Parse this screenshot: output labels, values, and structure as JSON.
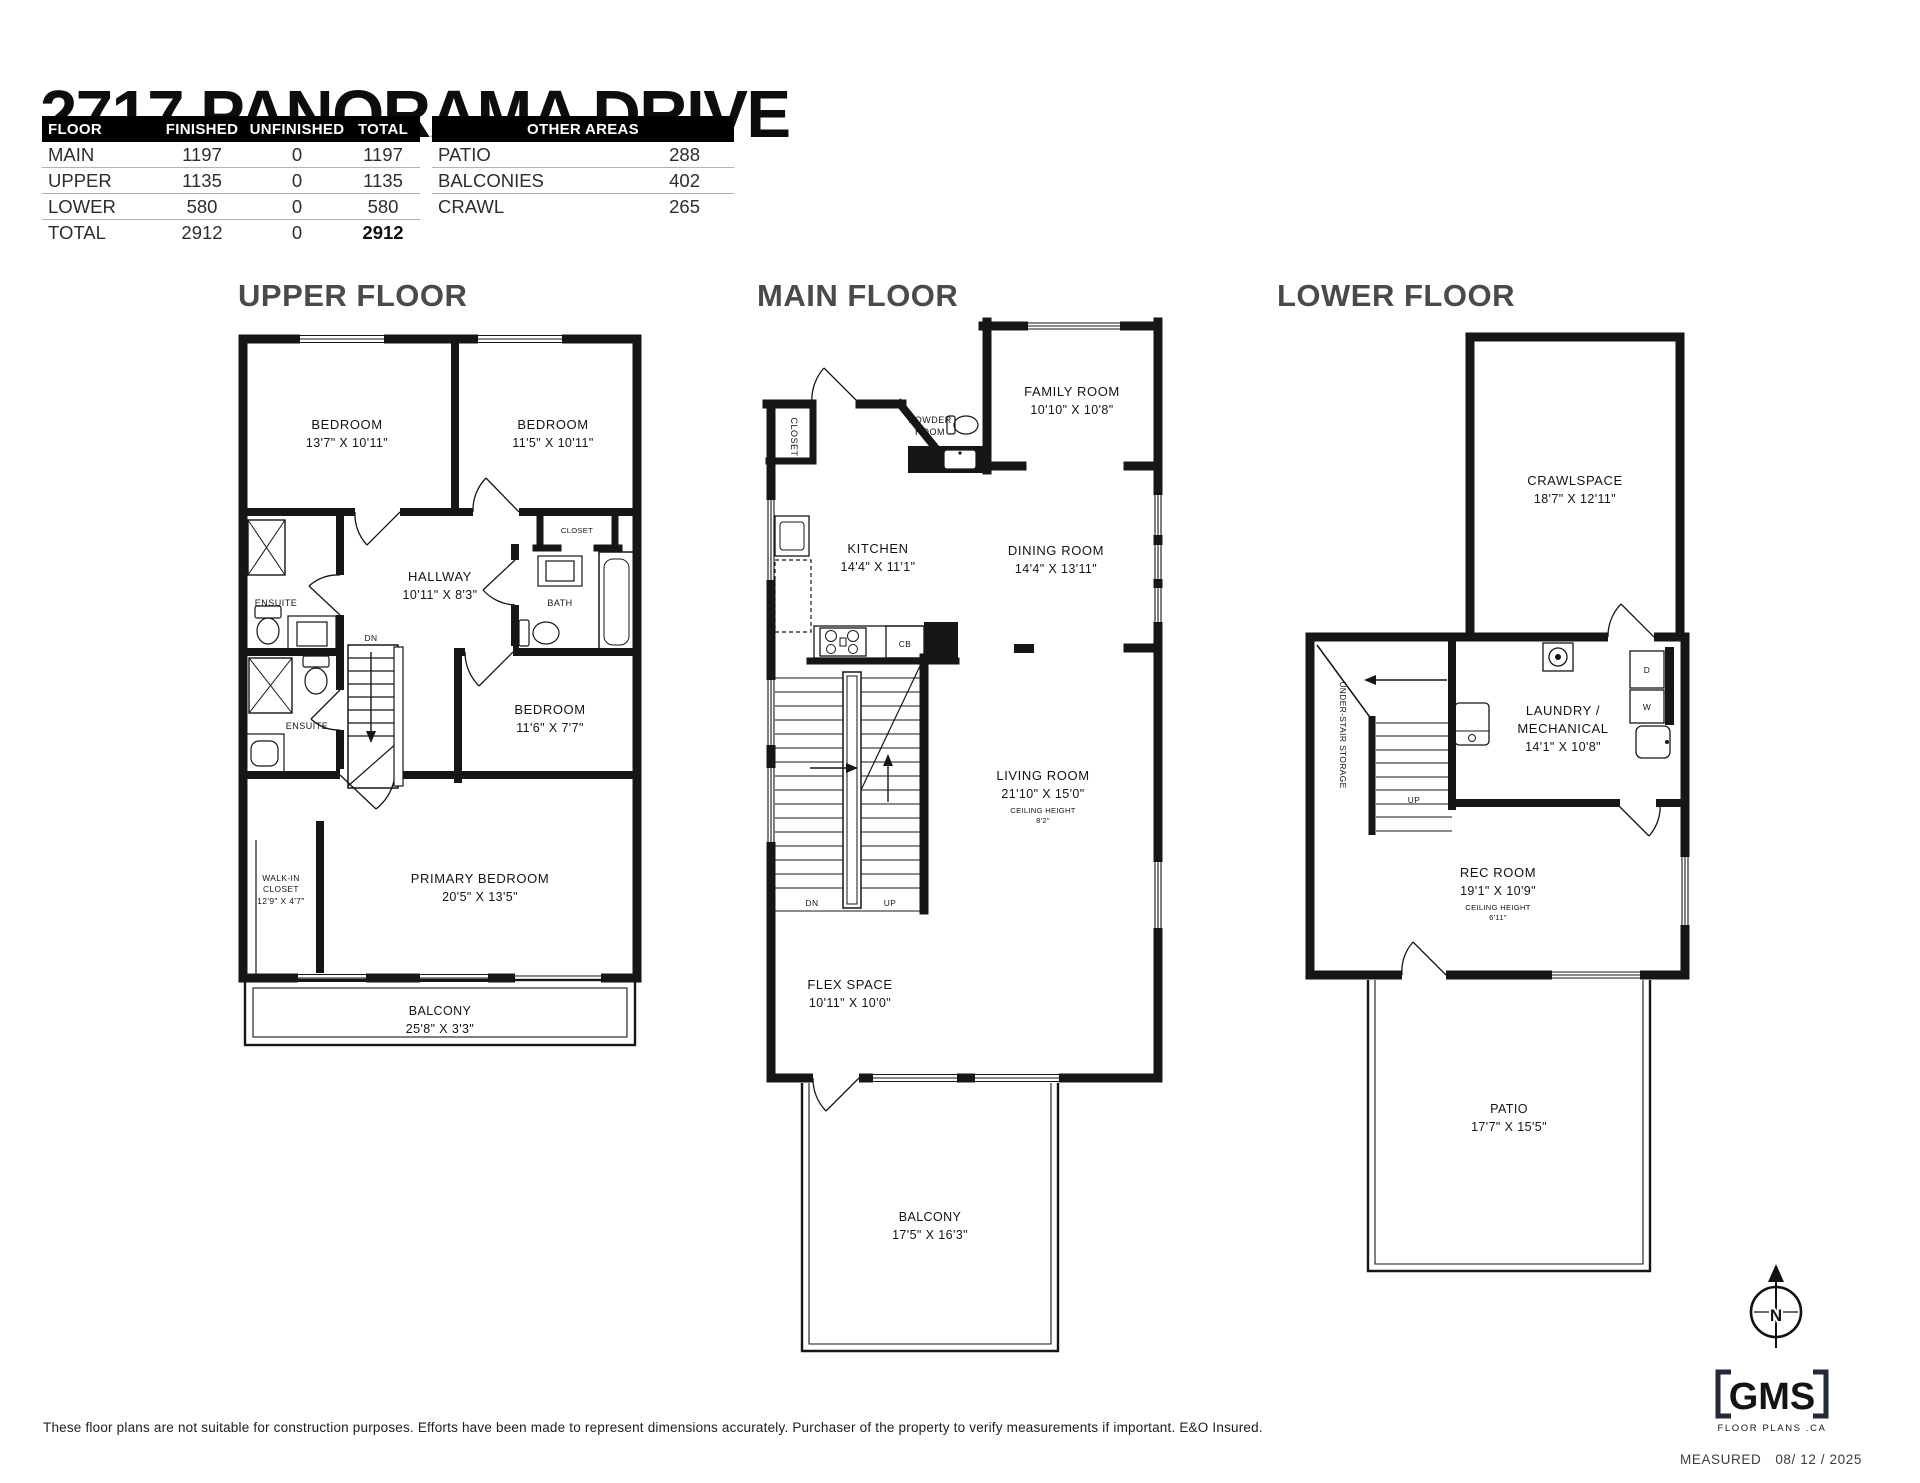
{
  "colors": {
    "wall": "#161616",
    "floor_title": "#4a4a4c",
    "header_bg": "#000000",
    "header_fg": "#ffffff",
    "logo": "#232936"
  },
  "title": "2717 PANORAMA DRIVE",
  "area_table": {
    "headers": [
      "FLOOR",
      "FINISHED",
      "UNFINISHED",
      "TOTAL"
    ],
    "rows": [
      {
        "floor": "MAIN",
        "finished": "1197",
        "unfinished": "0",
        "total": "1197"
      },
      {
        "floor": "UPPER",
        "finished": "1135",
        "unfinished": "0",
        "total": "1135"
      },
      {
        "floor": "LOWER",
        "finished": "580",
        "unfinished": "0",
        "total": "580"
      },
      {
        "floor": "TOTAL",
        "finished": "2912",
        "unfinished": "0",
        "total": "2912"
      }
    ]
  },
  "other_areas": {
    "header": "OTHER AREAS",
    "rows": [
      {
        "label": "PATIO",
        "value": "288"
      },
      {
        "label": "BALCONIES",
        "value": "402"
      },
      {
        "label": "CRAWL",
        "value": "265"
      }
    ]
  },
  "upper": {
    "title": "UPPER FLOOR",
    "bedroom1": {
      "name": "BEDROOM",
      "dims": "13'7\" X 10'11\""
    },
    "bedroom2": {
      "name": "BEDROOM",
      "dims": "11'5\" X 10'11\""
    },
    "hallway": {
      "name": "HALLWAY",
      "dims": "10'11\" X 8'3\""
    },
    "ensuite1": "ENSUITE",
    "ensuite2": "ENSUITE",
    "closet": "CLOSET",
    "bath": "BATH",
    "bedroom3": {
      "name": "BEDROOM",
      "dims": "11'6\" X 7'7\""
    },
    "walkin": {
      "line1": "WALK-IN",
      "line2": "CLOSET",
      "dims": "12'9\" X 4'7\""
    },
    "primary": {
      "name": "PRIMARY BEDROOM",
      "dims": "20'5\" X 13'5\""
    },
    "balcony": {
      "name": "BALCONY",
      "dims": "25'8\" X 3'3\""
    },
    "stairs_dn": "DN"
  },
  "main": {
    "title": "MAIN FLOOR",
    "family": {
      "name": "FAMILY ROOM",
      "dims": "10'10\" X 10'8\""
    },
    "powder": {
      "line1": "POWDER",
      "line2": "ROOM"
    },
    "closet": "CLOSET",
    "kitchen": {
      "name": "KITCHEN",
      "dims": "14'4\" X 11'1\""
    },
    "dining": {
      "name": "DINING ROOM",
      "dims": "14'4\" X 13'11\""
    },
    "cb": "CB",
    "stairs_dn": "DN",
    "stairs_up": "UP",
    "living": {
      "name": "LIVING ROOM",
      "dims": "21'10\" X 15'0\"",
      "ceiling_label": "CEILING HEIGHT",
      "ceiling_value": "8'2\""
    },
    "flex": {
      "name": "FLEX SPACE",
      "dims": "10'11\" X 10'0\""
    },
    "balcony": {
      "name": "BALCONY",
      "dims": "17'5\" X 16'3\""
    }
  },
  "lower": {
    "title": "LOWER FLOOR",
    "crawlspace": {
      "name": "CRAWLSPACE",
      "dims": "18'7\" X 12'11\""
    },
    "laundry": {
      "line1": "LAUNDRY /",
      "line2": "MECHANICAL",
      "dims": "14'1\" X 10'8\""
    },
    "storage": "UNDER-STAIR STORAGE",
    "stairs_up": "UP",
    "dryer": "D",
    "washer": "W",
    "rec": {
      "name": "REC ROOM",
      "dims": "19'1\" X 10'9\"",
      "ceiling_label": "CEILING HEIGHT",
      "ceiling_value": "6'11\""
    },
    "patio": {
      "name": "PATIO",
      "dims": "17'7\" X 15'5\""
    }
  },
  "footer": {
    "disclaimer": "These floor plans are not suitable for construction purposes. Efforts have been made to represent dimensions accurately.  Purchaser of the property to verify measurements if important.  E&O Insured.",
    "measured_label": "MEASURED",
    "measured_date": "08/ 12 / 2025",
    "logo_text": "GMS",
    "logo_sub": "FLOOR PLANS .CA",
    "compass_n": "N"
  }
}
